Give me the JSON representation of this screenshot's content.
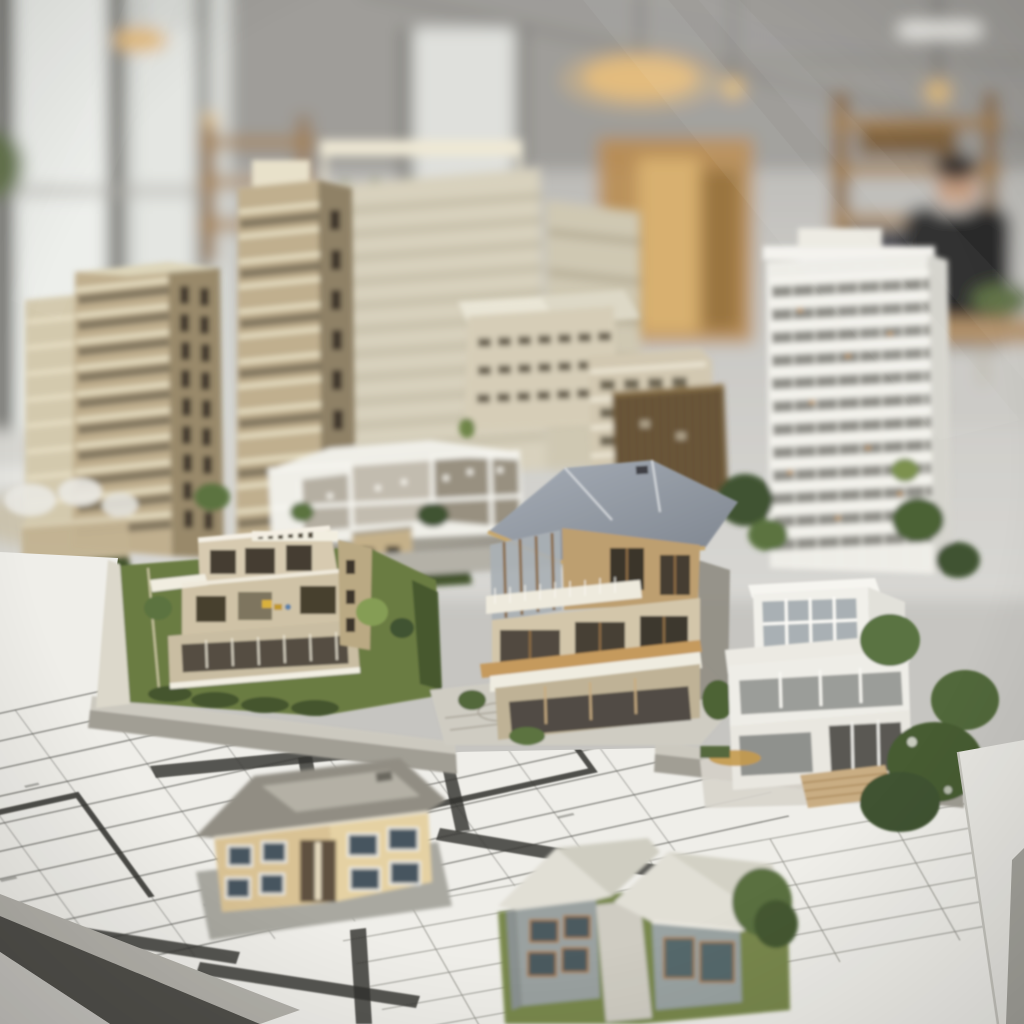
{
  "meta": {
    "title": "Architectural scale models of residential buildings on a table with floor-plan blueprints in an architecture office",
    "type": "photograph",
    "visible_text": "none (blueprint annotations are illegible at this resolution)"
  },
  "palette": {
    "bg-ceiling": "#a7a5a1",
    "bg-wall": "#c6c5c1",
    "window-bright": "#edefeb",
    "frame-dark": "#504e49",
    "warm-light": "#e5bd7d",
    "wood-shelf": "#a17c4c",
    "wood-dark": "#6b5334",
    "person-sweater": "#2c2b29",
    "skin": "#c7a084",
    "tan-wall": "#c0af8e",
    "tan-wall-dark": "#99896b",
    "tan-band": "#e6ddc2",
    "window-slot": "#3c362b",
    "cream": "#d8d1bd",
    "cream-line": "#b6ae97",
    "white-model": "#eeede7",
    "white-shade": "#d5d4cd",
    "glass-dark": "#6f6e67",
    "glass-blue": "#a9b0b4",
    "roof-a": "#a6adb6",
    "roof-b": "#7e858f",
    "fascia-wood": "#c6a76d",
    "house-wood": "#bd9f70",
    "interior-wood": "#8a6a45",
    "villa-wall": "#d5c8ac",
    "deck-white": "#f0ecdf",
    "lawn": "#6b7b43",
    "lawn-bright": "#79884e",
    "hedge": "#44552e",
    "tree-dark": "#3f5230",
    "tree-mid": "#5b7340",
    "tree-light": "#859d55",
    "road": "#b4b1a7",
    "platform-top": "#ccc9bf",
    "platform-front": "#a19e94",
    "board-white": "#efeee9",
    "plan-line": "#5f5f5a",
    "plan-thick": "#33332f",
    "plan-faint": "#97968f",
    "beige-house-wall": "#d9c294",
    "beige-house-wall-light": "#e5d1a3",
    "beige-house-roof": "#918d83",
    "beige-house-roof-top": "#b4b0a5",
    "house-window": "#47545f",
    "gray-house-wall": "#9aa1a0",
    "gray-house-roof": "#e1dfd5",
    "gray-house-roof-shade": "#cfcdc1",
    "accent-orange": "#b87f3e",
    "steps-wood": "#c9ad83",
    "sheet-white": "#e7e6e1",
    "table-dark": "#504f4a",
    "floor-light": "#c6c4bf",
    "timber-dark": "#6e5a3b",
    "timber-line": "#4c3b25"
  },
  "scene": {
    "background": {
      "setting": "blurred architecture office interior seen through glass",
      "elements": [
        "window wall with dark mullions (left)",
        "gray industrial ceiling",
        "round pendant lamp and hanging bulbs",
        "wooden shelving racks with models",
        "person in dark sweater at a wooden table (right)",
        "warm lit cabinet (center)"
      ]
    },
    "midground_models": [
      {
        "id": "tan-tower-left",
        "desc": "beige apartment tower, ~11 floors, balcony bands, dark window slots on side face"
      },
      {
        "id": "tan-tower-second",
        "desc": "taller narrow beige tower with rooftop structures"
      },
      {
        "id": "cream-tower-center",
        "desc": "cream high-rise with rooftop pergola frame and roof garden greenery"
      },
      {
        "id": "white-tower-right",
        "desc": "white balcony-grid tower, ~13 floors"
      },
      {
        "id": "stepped-midrise",
        "desc": "cream stepped mid-rise block with hip roofs and rows of dark openings"
      },
      {
        "id": "timber-midrise",
        "desc": "dark timber-clad mid-rise block"
      },
      {
        "id": "cutaway-deck-model",
        "desc": "white cut-away section model with open floor plates and tiny lights"
      }
    ],
    "foreground_models": [
      {
        "id": "tan-villa",
        "desc": "flat-roof cream villa with terraces, yellow furniture dots, glass lower floor, landscaped lawn and trees"
      },
      {
        "id": "wood-house",
        "desc": "three-story cut-away house, gray hip roof, timber frames, white balcony bands, patterned forecourt"
      },
      {
        "id": "white-box-house",
        "desc": "white modernist two-story house with rooftop glass penthouse and wooden entry steps"
      }
    ],
    "baseboard": {
      "desc": "white model baseboard with printed floor plans; thick dark wall lines, thin grid lines, illegible annotations",
      "standalone_houses": [
        {
          "id": "beige-house",
          "desc": "two-story beige house with gray hip roof and recessed entry, sitting on plan"
        },
        {
          "id": "gray-house",
          "desc": "gray two-volume house with pale hip roofs, orange window accents, lawn patch and small tree"
        }
      ]
    },
    "table": {
      "desc": "dark table edge visible at lower-left corner; tilted white drawing sheet at lower-right"
    }
  }
}
